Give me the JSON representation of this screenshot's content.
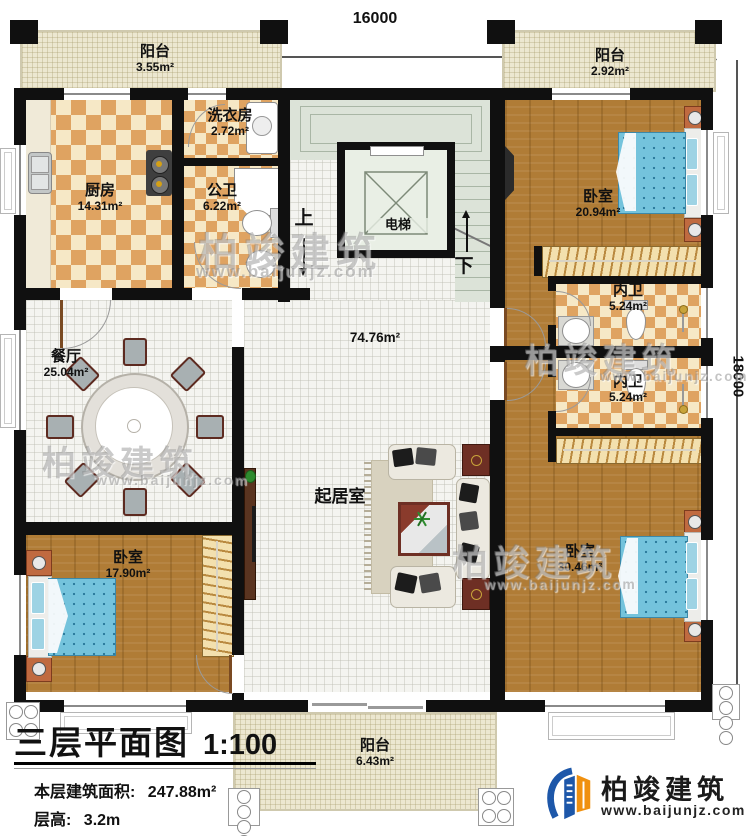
{
  "dimensions": {
    "top": "16000",
    "right": "18000"
  },
  "stairs": {
    "up": "上",
    "down": "下"
  },
  "rooms": {
    "balcony_top_left": {
      "name": "阳台",
      "area": "3.55m²"
    },
    "balcony_top_right": {
      "name": "阳台",
      "area": "2.92m²"
    },
    "balcony_bottom": {
      "name": "阳台",
      "area": "6.43m²"
    },
    "kitchen": {
      "name": "厨房",
      "area": "14.31m²"
    },
    "laundry": {
      "name": "洗衣房",
      "area": "2.72m²"
    },
    "public_bath": {
      "name": "公卫",
      "area": "6.22m²"
    },
    "elevator": {
      "name": "电梯"
    },
    "bedroom_top_right": {
      "name": "卧室",
      "area": "20.94m²"
    },
    "ensuite_bath_top": {
      "name": "内卫",
      "area": "5.24m²"
    },
    "ensuite_bath_bottom": {
      "name": "内卫",
      "area": "5.24m²"
    },
    "dining": {
      "name": "餐厅",
      "area": "25.04m²"
    },
    "hall": {
      "area": "74.76m²"
    },
    "living": {
      "name": "起居室"
    },
    "bedroom_bottom_left": {
      "name": "卧室",
      "area": "17.90m²"
    },
    "bedroom_bottom_right": {
      "name": "卧室",
      "area": "30.46m²"
    }
  },
  "title_block": {
    "title": "三层平面图",
    "scale": "1:100",
    "area_label": "本层建筑面积:",
    "area_value": "247.88m²",
    "floor_height_label": "层高:",
    "floor_height_value": "3.2m"
  },
  "branding": {
    "watermark_text": "柏竣建筑",
    "watermark_url": "www.baijunjz.com",
    "logo_name": "柏竣建筑",
    "logo_url": "www.baijunjz.com"
  },
  "colors": {
    "wall": "#101010",
    "checker_dark": "#dfa361",
    "checker_light": "#f6e8c6",
    "wood": "#b07c36",
    "bed_blue": "#74c3dc",
    "logo_blue": "#1d57a9",
    "logo_orange": "#f0900f"
  }
}
